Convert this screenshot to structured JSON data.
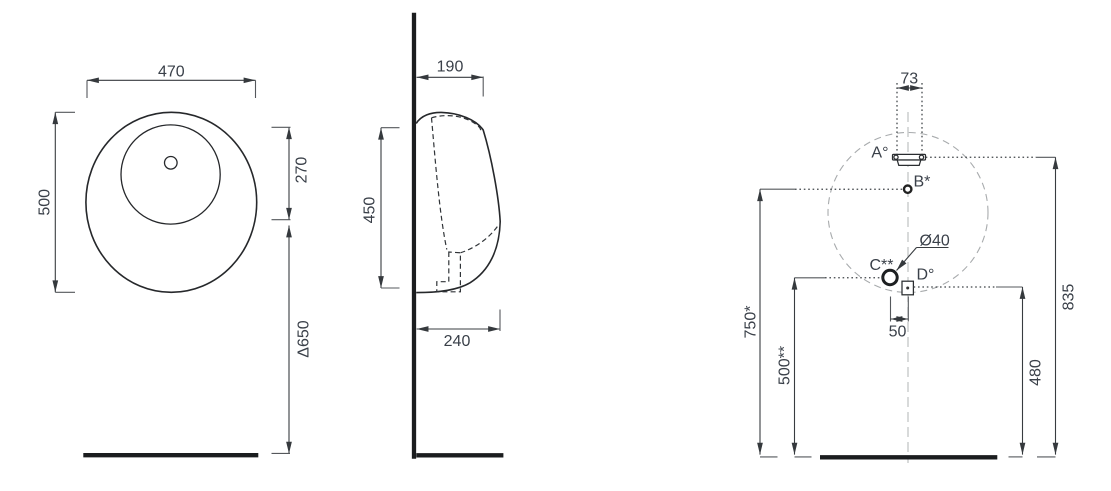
{
  "front": {
    "width": "470",
    "height": "500",
    "inner_height": "270",
    "mount_height": "Δ650"
  },
  "side": {
    "top_depth": "190",
    "height": "450",
    "bottom_depth": "240"
  },
  "install": {
    "inlet_width": "73",
    "offset": "50",
    "drain_dia": "Ø40",
    "height_total": "835",
    "height_b": "750*",
    "height_c": "500**",
    "height_d": "480",
    "label_a": "A°",
    "label_b": "B*",
    "label_c": "C**",
    "label_d": "D°"
  }
}
